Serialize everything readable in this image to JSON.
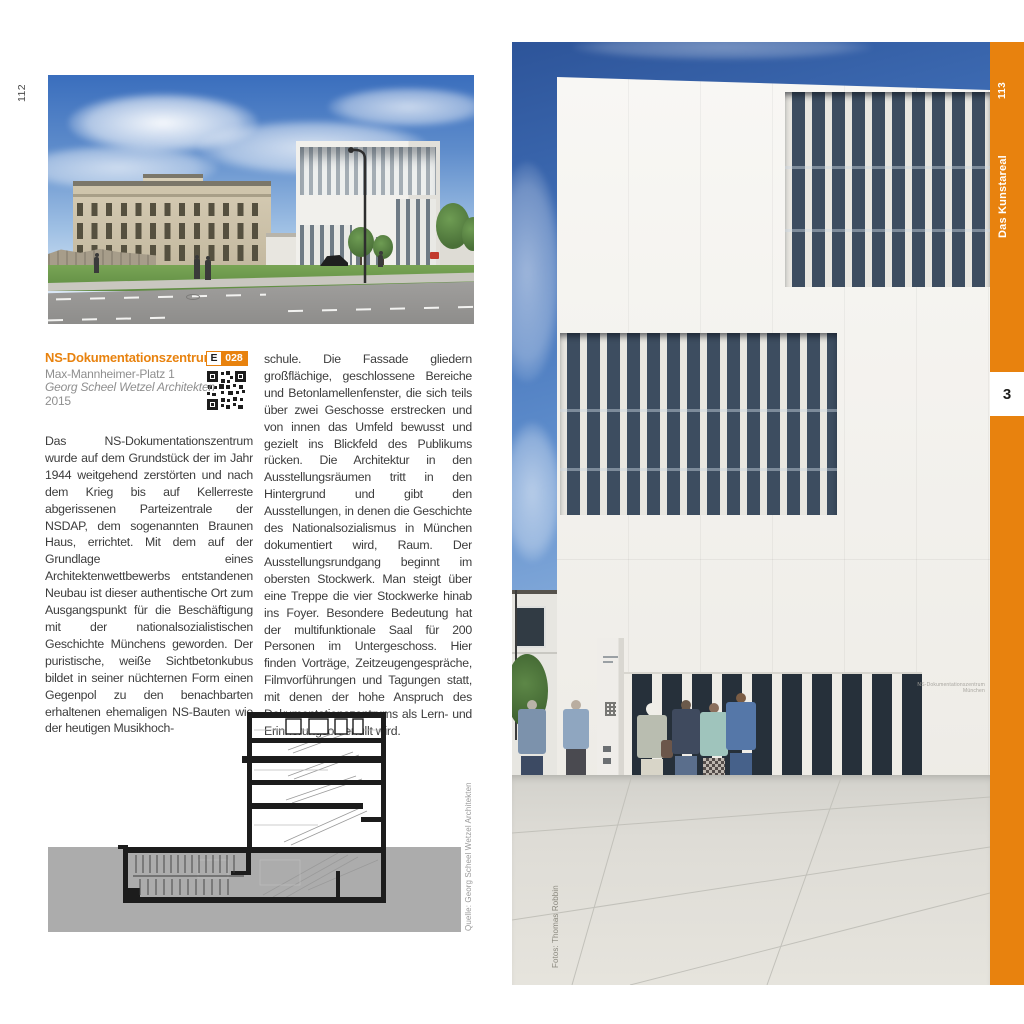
{
  "left_page": {
    "page_number": "112",
    "entry": {
      "title": "NS-Dokumentationszentrum",
      "badge_letter": "E",
      "badge_number": "028",
      "address": "Max-Mannheimer-Platz 1",
      "architect": "Georg Scheel Wetzel Architekten",
      "year": "2015"
    },
    "body_column_1": "Das NS-Dokumentationszentrum wurde auf dem Grundstück der im Jahr 1944 weitgehend zerstörten und nach dem Krieg bis auf Kellerreste abgerissenen Parteizentrale der NSDAP, dem sogenannten Braunen Haus, errichtet. Mit dem auf der Grundlage eines Architektenwettbewerbs entstandenen Neubau ist dieser authentische Ort zum Ausgangspunkt für die Beschäftigung mit der nationalsozialistischen Geschichte Münchens geworden. Der puristische, weiße Sichtbetonkubus bildet in seiner nüchternen Form einen Gegenpol zu den benachbarten erhaltenen ehemaligen NS-Bauten wie der heutigen Musikhoch-",
    "body_column_2": "schule. Die Fassade gliedern großflächige, geschlossene Bereiche und Betonlamellenfenster, die sich teils über zwei Geschosse erstrecken und von innen das Umfeld bewusst und gezielt ins Blickfeld des Publikums rücken. Die Architektur in den Ausstellungsräumen tritt in den Hintergrund und gibt den Ausstellungen, in denen die Geschichte des Nationalsozialismus in München dokumentiert wird, Raum. Der Ausstellungsrundgang beginnt im obersten Stockwerk. Man steigt über eine Treppe die vier Stockwerke hinab ins Foyer. Besondere Bedeutung hat der multifunktionale Saal für 200 Personen im Untergeschoss. Hier finden Vorträge, Zeitzeugengespräche, Filmvorführungen und Tagungen statt, mit denen der hohe Anspruch des Dokumentationszentrums als Lern- und Erinnerungsort erfüllt wird.",
    "drawing_credit": "Quelle: Georg Scheel Wetzel Architekten"
  },
  "right_page": {
    "page_number": "113",
    "chapter_tab": "Das Kunstareal",
    "chapter_index": "3",
    "photo_credit": "Fotos: Thomas Robbin",
    "building_sign": [
      "NS-Dokumentationszentrum",
      "München"
    ]
  },
  "colors": {
    "accent_orange": "#E8820E",
    "body_text": "#3C3C3C",
    "muted_text": "#8F8F8F",
    "drawing_band_gray": "#ACACAC"
  }
}
